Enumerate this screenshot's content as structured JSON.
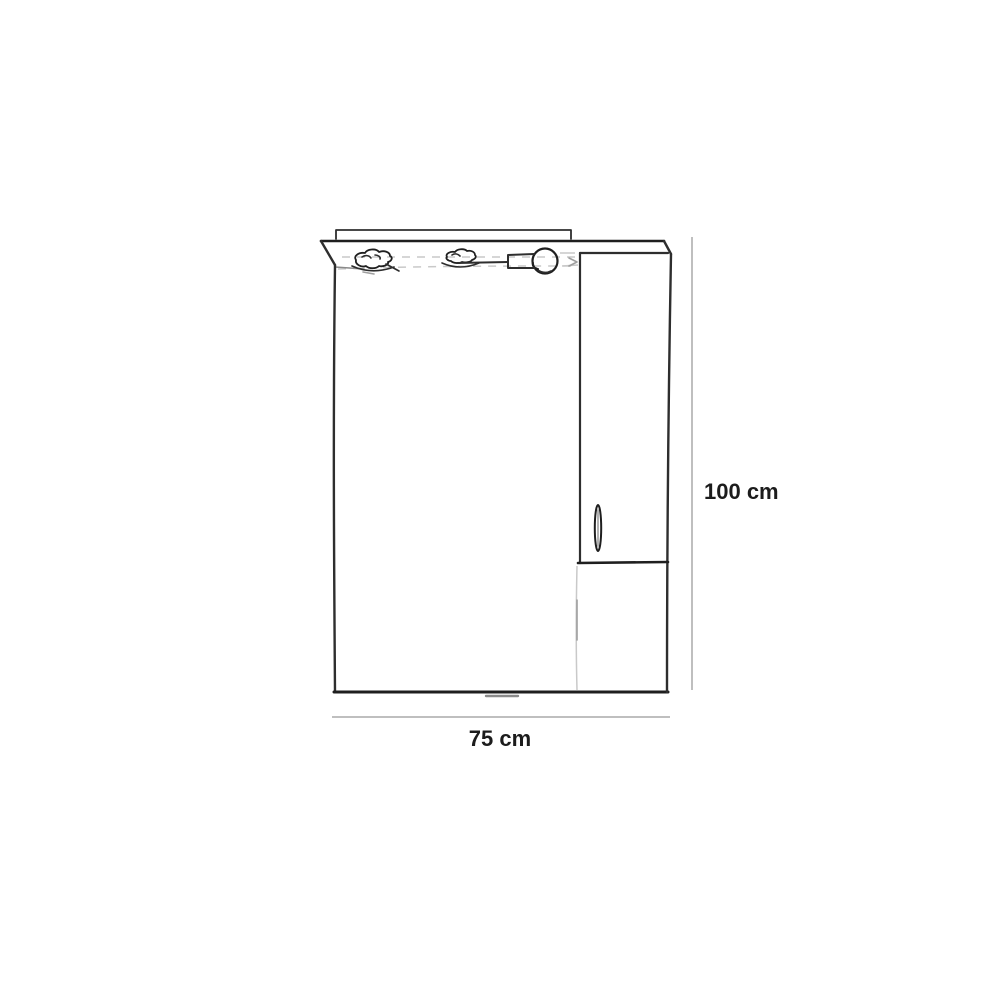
{
  "diagram": {
    "kind": "furniture-dimension-line-drawing",
    "labels": {
      "width": "75 cm",
      "height": "100 cm"
    }
  },
  "icons": {
    "light_left": "sconce-light-icon",
    "light_center": "sconce-light-icon",
    "light_right": "bulb-light-icon",
    "handle": "door-handle-icon"
  },
  "colors": {
    "background": "#ffffff",
    "line": "#2e2e2e",
    "line_dark": "#1f1f1f",
    "dimension_line": "#bfbfbf",
    "faint_line": "#c9c9c9",
    "label_text": "#1c1c1c"
  }
}
